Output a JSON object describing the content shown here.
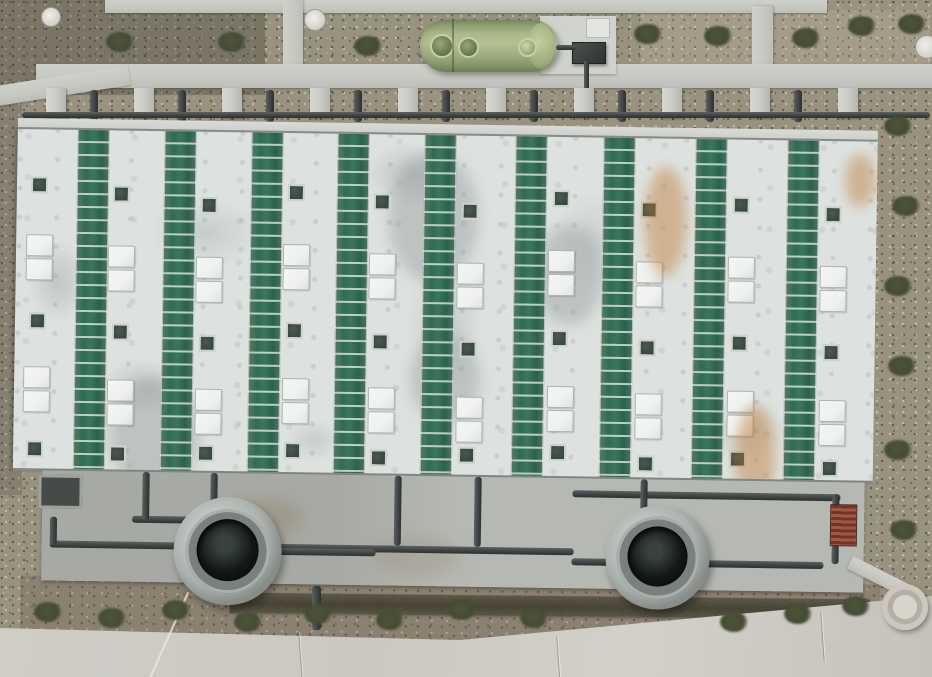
{
  "scene": {
    "type": "aerial-photograph",
    "subject": "wastewater treatment plant covered basin, top-down drone view",
    "elements": [
      "striped basin roof",
      "FRP storage tank",
      "pipe gallery",
      "aeration tanks",
      "concrete paths",
      "gravel grounds",
      "access road"
    ]
  },
  "colors": {
    "gravel": "#99927f",
    "path": "#c9c9c3",
    "pad": "#d0d3cd",
    "roofWhite": "#dde2e0",
    "roofGreen": "#2f6b54",
    "vent": "#37463e",
    "skylight": "#eff1ef",
    "beam": "#cdd0cb",
    "pipe": "#45494b",
    "apron": "#b6b8b3",
    "apronDark": "#a7a9a4",
    "tankGreen": "#a3b283",
    "dirt": "#8b8170",
    "shrub": "#454b33",
    "road": "#cbc8c2",
    "rust": "#bf7a33",
    "redStairs": "#8a4434",
    "well": "#c6c2b8"
  },
  "building": {
    "green_stripe_count": 9,
    "stripe_lefts": [
      60,
      147,
      234,
      320,
      407,
      498,
      586,
      678,
      770
    ],
    "stripe_width": 30,
    "features": [
      [
        14,
        58,
        "v"
      ],
      [
        10,
        116,
        "s"
      ],
      [
        10,
        140,
        "s"
      ],
      [
        14,
        194,
        "v"
      ],
      [
        9,
        248,
        "s"
      ],
      [
        9,
        272,
        "s"
      ],
      [
        13,
        322,
        "v"
      ],
      [
        96,
        66,
        "v"
      ],
      [
        92,
        126,
        "s"
      ],
      [
        92,
        150,
        "s"
      ],
      [
        97,
        204,
        "v"
      ],
      [
        93,
        260,
        "s"
      ],
      [
        93,
        284,
        "s"
      ],
      [
        96,
        326,
        "v"
      ],
      [
        184,
        76,
        "v"
      ],
      [
        180,
        136,
        "s"
      ],
      [
        180,
        160,
        "s"
      ],
      [
        184,
        214,
        "v"
      ],
      [
        181,
        268,
        "s"
      ],
      [
        181,
        292,
        "s"
      ],
      [
        184,
        324,
        "v"
      ],
      [
        271,
        62,
        "v"
      ],
      [
        267,
        122,
        "s"
      ],
      [
        267,
        146,
        "s"
      ],
      [
        271,
        200,
        "v"
      ],
      [
        268,
        256,
        "s"
      ],
      [
        268,
        280,
        "s"
      ],
      [
        271,
        320,
        "v"
      ],
      [
        357,
        70,
        "v"
      ],
      [
        353,
        130,
        "s"
      ],
      [
        353,
        154,
        "s"
      ],
      [
        357,
        210,
        "v"
      ],
      [
        354,
        264,
        "s"
      ],
      [
        354,
        288,
        "s"
      ],
      [
        357,
        326,
        "v"
      ],
      [
        445,
        78,
        "v"
      ],
      [
        441,
        138,
        "s"
      ],
      [
        441,
        162,
        "s"
      ],
      [
        445,
        216,
        "v"
      ],
      [
        442,
        272,
        "s"
      ],
      [
        442,
        296,
        "s"
      ],
      [
        445,
        322,
        "v"
      ],
      [
        536,
        64,
        "v"
      ],
      [
        532,
        124,
        "s"
      ],
      [
        532,
        148,
        "s"
      ],
      [
        536,
        204,
        "v"
      ],
      [
        533,
        260,
        "s"
      ],
      [
        533,
        284,
        "s"
      ],
      [
        536,
        318,
        "v"
      ],
      [
        624,
        74,
        "v"
      ],
      [
        620,
        134,
        "s"
      ],
      [
        620,
        158,
        "s"
      ],
      [
        624,
        212,
        "v"
      ],
      [
        621,
        266,
        "s"
      ],
      [
        621,
        290,
        "s"
      ],
      [
        624,
        328,
        "v"
      ],
      [
        716,
        68,
        "v"
      ],
      [
        712,
        128,
        "s"
      ],
      [
        712,
        152,
        "s"
      ],
      [
        716,
        206,
        "v"
      ],
      [
        713,
        262,
        "s"
      ],
      [
        713,
        286,
        "s"
      ],
      [
        716,
        322,
        "v"
      ],
      [
        808,
        76,
        "v"
      ],
      [
        804,
        136,
        "s"
      ],
      [
        804,
        160,
        "s"
      ],
      [
        808,
        214,
        "v"
      ],
      [
        805,
        270,
        "s"
      ],
      [
        805,
        294,
        "s"
      ],
      [
        808,
        330,
        "v"
      ]
    ],
    "rust_stains": [
      [
        628,
        30,
        42,
        110
      ],
      [
        722,
        268,
        40,
        100
      ],
      [
        828,
        14,
        30,
        54
      ]
    ],
    "gray_stains": [
      [
        372,
        20,
        90,
        130
      ],
      [
        96,
        250,
        90,
        110
      ],
      [
        518,
        90,
        70,
        100
      ],
      [
        396,
        200,
        70,
        90
      ]
    ]
  },
  "gallery": {
    "pillar_xs": [
      46,
      134,
      222,
      310,
      398,
      486,
      574,
      662,
      750,
      838
    ],
    "riser_xs": [
      90,
      178,
      266,
      354,
      442,
      530,
      618,
      706,
      794
    ]
  },
  "apron_pipes": {
    "horizontal": [
      [
        38,
        422,
        524
      ],
      [
        560,
        432,
        252
      ],
      [
        560,
        364,
        268
      ],
      [
        120,
        396,
        100
      ],
      [
        268,
        426,
        96
      ]
    ],
    "vertical": [
      [
        130,
        352,
        48
      ],
      [
        198,
        352,
        30
      ],
      [
        382,
        352,
        70
      ],
      [
        462,
        352,
        70
      ],
      [
        628,
        352,
        32
      ],
      [
        820,
        364,
        70
      ],
      [
        38,
        398,
        28
      ]
    ]
  },
  "process_tanks": [
    {
      "cx": 216,
      "cy": 430,
      "r": 54
    },
    {
      "cx": 646,
      "cy": 430,
      "r": 52
    }
  ],
  "shrubs": {
    "top": [
      [
        120,
        42
      ],
      [
        232,
        42
      ],
      [
        368,
        46
      ],
      [
        648,
        34
      ],
      [
        718,
        36
      ],
      [
        806,
        38
      ],
      [
        862,
        26
      ],
      [
        912,
        24
      ]
    ],
    "right": [
      [
        898,
        126
      ],
      [
        906,
        206
      ],
      [
        898,
        286
      ],
      [
        902,
        366
      ],
      [
        898,
        450
      ],
      [
        904,
        530
      ]
    ],
    "bottom": [
      [
        48,
        612
      ],
      [
        112,
        618
      ],
      [
        176,
        610
      ],
      [
        248,
        622
      ],
      [
        318,
        614
      ],
      [
        390,
        620
      ],
      [
        462,
        610
      ],
      [
        534,
        618
      ],
      [
        734,
        622
      ],
      [
        798,
        614
      ],
      [
        856,
        606
      ]
    ]
  },
  "manholes": [
    [
      50,
      16,
      9
    ],
    [
      314,
      19,
      10
    ],
    [
      926,
      46,
      11
    ]
  ],
  "road_joints": [
    [
      300,
      632
    ],
    [
      558,
      636
    ],
    [
      822,
      612
    ]
  ]
}
